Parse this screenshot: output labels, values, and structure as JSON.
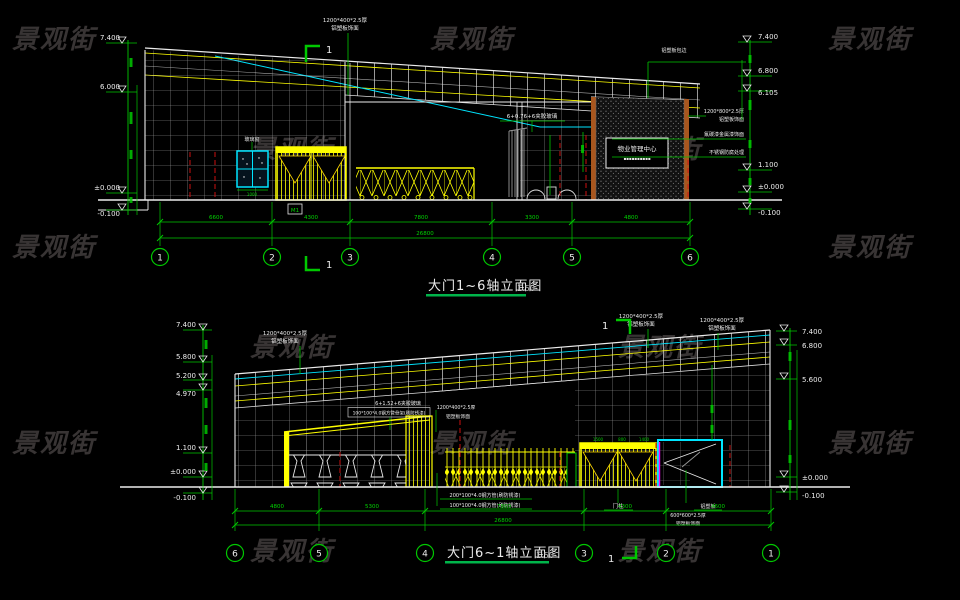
{
  "watermark": {
    "text": "景观街"
  },
  "top_view": {
    "title": "大门1~6轴立面图",
    "scale": "1:50",
    "section_label": "1",
    "axes": [
      "1",
      "2",
      "3",
      "4",
      "5",
      "6"
    ],
    "dim_segments": [
      "6600",
      "4300",
      "7800",
      "3300",
      "4800"
    ],
    "dim_total": "26800",
    "levels_left": [
      "7.400",
      "6.000",
      "±0.000",
      "-0.100"
    ],
    "levels_right": [
      "7.400",
      "6.800",
      "6.105",
      "1.100",
      "±0.000",
      "-0.100"
    ],
    "annotations": {
      "roof_line1": "1200*400*2.5厚",
      "roof_line2": "铝塑板饰面",
      "glass": "6+0.76+6夹胶玻璃",
      "window": "玻璃窗",
      "window_dim": "1000",
      "sign_top": "铝塑板包边",
      "gate_tag": "M1",
      "note1": "1200*800*2.5厚",
      "note2": "铝塑板饰面",
      "note3": "氟碳漆金属漆饰面",
      "note4": "不锈钢防腐处理",
      "sign_line1": "物业管理中心",
      "sign_line2": "▪▪▪▪▪▪▪▪▪▪"
    }
  },
  "bottom_view": {
    "title": "大门6~1轴立面图",
    "scale": "1:50",
    "section_label": "1",
    "axes": [
      "6",
      "5",
      "4",
      "3",
      "2",
      "1"
    ],
    "dim_segments": [
      "4800",
      "5300",
      "7800",
      "4300",
      "4600"
    ],
    "dim_total": "26800",
    "levels_left": [
      "7.400",
      "5.800",
      "5.200",
      "4.970",
      "1.100",
      "±0.000",
      "-0.100"
    ],
    "levels_right": [
      "7.400",
      "6.800",
      "5.600",
      "±0.000",
      "-0.100"
    ],
    "gate_dims": [
      "1500",
      "800",
      "1400"
    ],
    "annotations": {
      "roof_left_line1": "1200*400*2.5厚",
      "roof_left_line2": "铝塑板饰面",
      "roof_mid_line1": "1200*400*2.5厚",
      "roof_mid_line2": "铝塑板饰面",
      "roof_right_line1": "1200*400*2.5厚",
      "roof_right_line2": "铝塑板饰面",
      "glass_line1": "6+1.52+6夹胶玻璃",
      "glass_line2": "100*100*4.0钢方管骨架(刷防锈漆)",
      "mid_line1": "1200*400*2.5厚",
      "mid_line2": "铝塑板饰面",
      "below_line1": "200*100*4.0钢方管(刷防锈漆)",
      "below_line2": "100*100*4.0钢方管(刷防锈漆)",
      "gatepost": "门柱",
      "right1": "铝塑板",
      "right2": "600*600*2.5厚",
      "right3": "铝塑板饰面"
    }
  },
  "colors": {
    "dim_green": "#00d400",
    "gate_yellow": "#ffff00",
    "frame_cyan": "#00e5ff",
    "wall_brown": "#a8561e",
    "axis_red": "#cc1111",
    "magenta": "#ff00ff"
  }
}
